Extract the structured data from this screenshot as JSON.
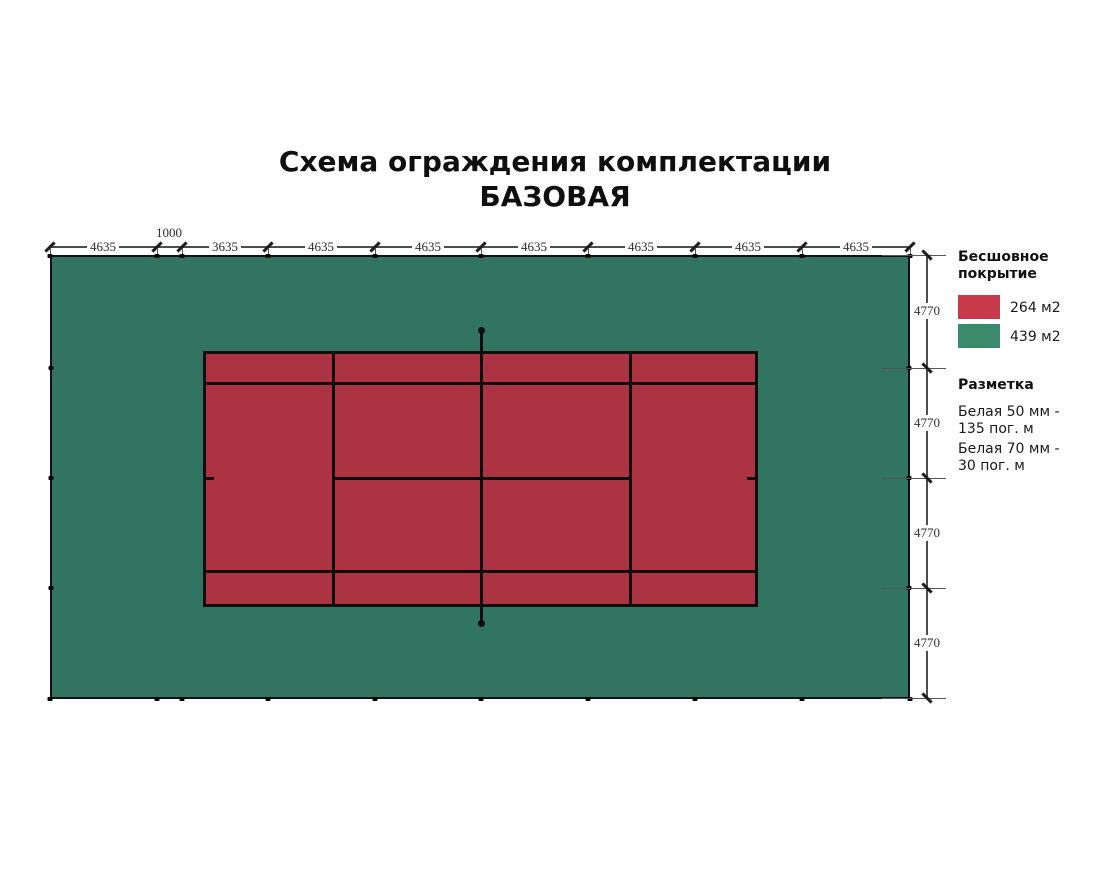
{
  "title": {
    "line1": "Схема ограждения комплектации",
    "line2": "БАЗОВАЯ"
  },
  "dims": {
    "top": [
      "4635",
      "1000",
      "3635",
      "4635",
      "4635",
      "4635",
      "4635",
      "4635",
      "4635"
    ],
    "right": [
      "4770",
      "4770",
      "4770",
      "4770"
    ]
  },
  "legend": {
    "coating_title": "Бесшовное покрытие",
    "coating_items": [
      {
        "name": "red-coating",
        "color": "#c63a4b",
        "label": "264 м2"
      },
      {
        "name": "green-coating",
        "color": "#3b8a6d",
        "label": "439 м2"
      }
    ],
    "marking_title": "Разметка",
    "marking_items": [
      {
        "line1": "Белая 50 мм -",
        "line2": "135 пог. м"
      },
      {
        "line1": "Белая 70 мм -",
        "line2": "30 пог. м"
      }
    ]
  },
  "colors": {
    "field_green": "#317561",
    "court_red": "#ab3342",
    "legend_red": "#c63a4b",
    "legend_green": "#3b8a6d",
    "line_black": "#0d0d0d"
  }
}
